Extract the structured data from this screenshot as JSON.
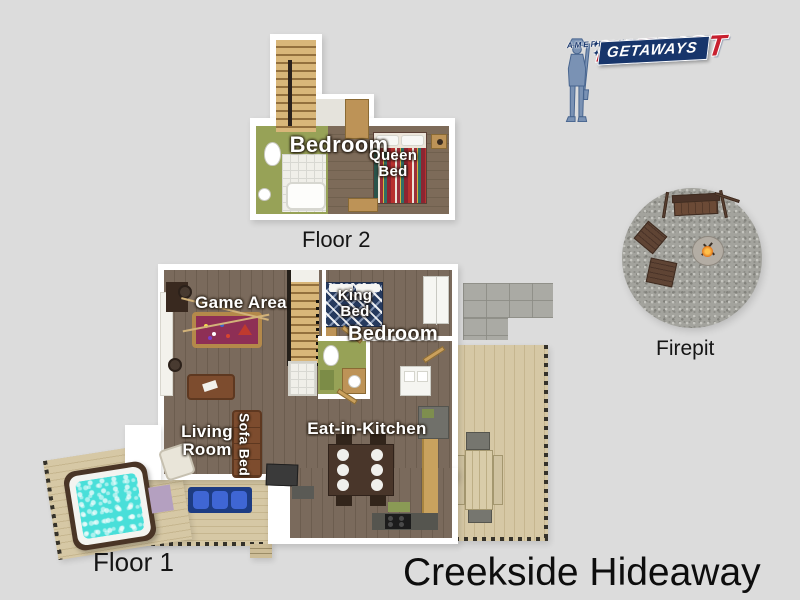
{
  "page": {
    "title": "Creekside Hideaway"
  },
  "logo": {
    "stars_left": "✦ ✦",
    "line1": "AMERICAN",
    "stars_right": "✦ ✦",
    "line2": "PATRIOT",
    "line3": "GETAWAYS"
  },
  "floor2": {
    "caption": "Floor 2",
    "labels": {
      "bedroom": "Bedroom",
      "queen_bed": "Queen Bed"
    }
  },
  "floor1": {
    "caption": "Floor 1",
    "labels": {
      "game_area": "Game Area",
      "king_bed": "King Bed",
      "bedroom": "Bedroom",
      "living_room": "Living Room",
      "sofa_bed": "Sofa Bed",
      "eat_in_kitchen": "Eat-in-Kitchen"
    }
  },
  "firepit": {
    "caption": "Firepit"
  },
  "colors": {
    "background": "#dcdcdc",
    "logo_red": "#c8202f",
    "logo_navy": "#17356b",
    "logo_figure_blue": "#7a92b4",
    "pool_table_felt": "#8e2f55",
    "hot_tub_water": "#49dfd9",
    "bathroom_green": "#97a257",
    "wood_floor": "#7a6a5c",
    "deck_wood": "#d6c8a5",
    "room_label_text": "#ffffff",
    "caption_text": "#151515"
  }
}
